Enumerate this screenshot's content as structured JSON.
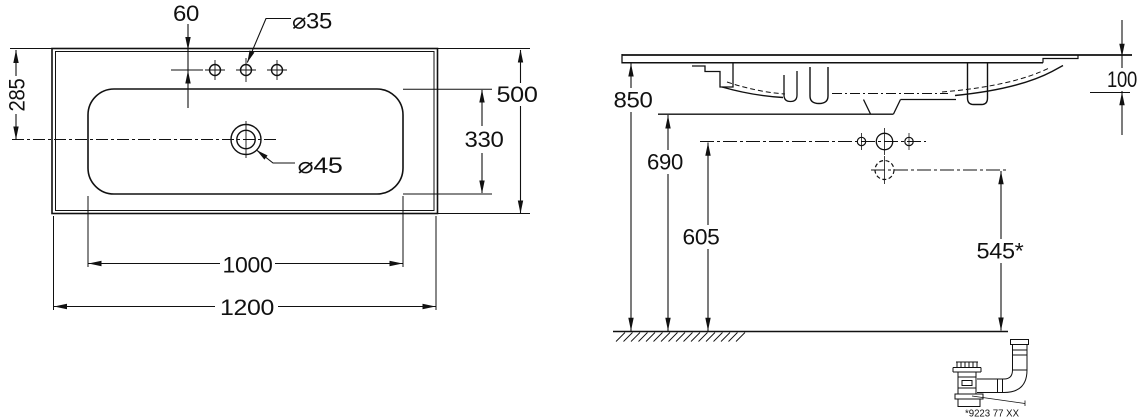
{
  "drawing": {
    "type": "technical-dimension-drawing",
    "colors": {
      "line": "#111111",
      "background": "#ffffff"
    },
    "top_view": {
      "label_hole_offset": "60",
      "label_faucet_hole_diameter": "⌀35",
      "label_depth_to_drain": "285",
      "label_overall_depth": "500",
      "label_basin_depth": "330",
      "label_drain_diameter": "⌀45",
      "label_basin_width": "1000",
      "label_overall_width": "1200"
    },
    "side_view": {
      "label_rim_height": "850",
      "label_underside_height": "690",
      "label_faucet_row_height": "605",
      "label_drain_height": "545*",
      "label_front_edge_height": "100",
      "siphon_part_number": "*9223 77 XX"
    }
  }
}
